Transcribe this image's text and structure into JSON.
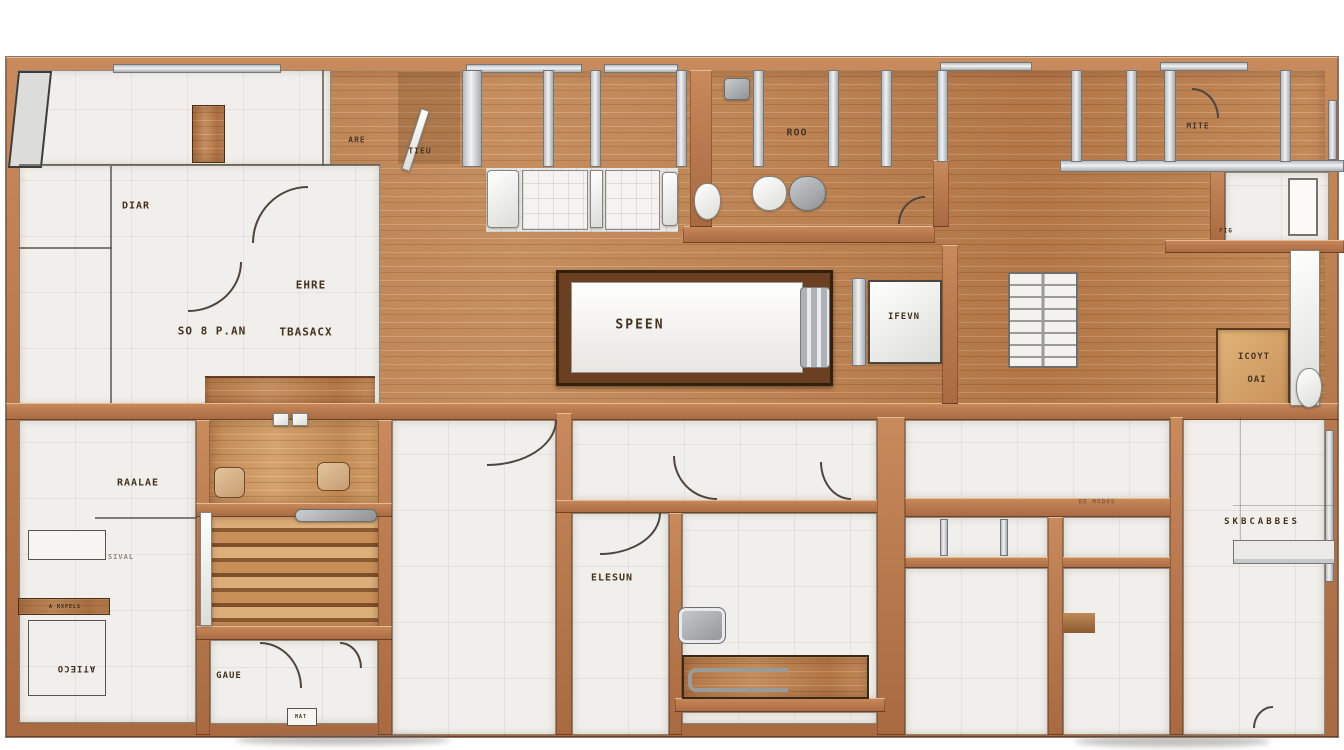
{
  "plan": {
    "description": "Top-down architectural floor plan rendering with copper-wood walls, white tiled rooms and wooden plank corridors",
    "colors": {
      "wall_copper": "#b97a4e",
      "wall_edge_dark": "#48260f",
      "wood_floor": "#bd8252",
      "wood_cabinet_light": "#d9a869",
      "room_white": "#f1efeb",
      "fixture_silver": "#d8dadd",
      "annotation_ink": "#44311d",
      "background": "#ffffff"
    }
  },
  "labels": {
    "are": "ARE",
    "tieu": "TIEU",
    "diar": "DIAR",
    "ehre": "EHRE",
    "soban": "SO 8 P.AN",
    "tbasacx": "TBASACX",
    "speen": "SPEEN",
    "roo": "ROO",
    "ifevn": "IFEVN",
    "mite": "MITE",
    "fig": "FIG",
    "icoyt": "ICOYT",
    "oai": "OAI",
    "skbchbaes": "SKBCABBES",
    "raalae": "RAALAE",
    "sival": "SIVAL",
    "anxpels": "A NXPELS",
    "atieco": "ATIECO",
    "gaue": "GAUE",
    "elesun": "ELESUN",
    "demodos": "DE MODOS",
    "mat": "MAT"
  }
}
